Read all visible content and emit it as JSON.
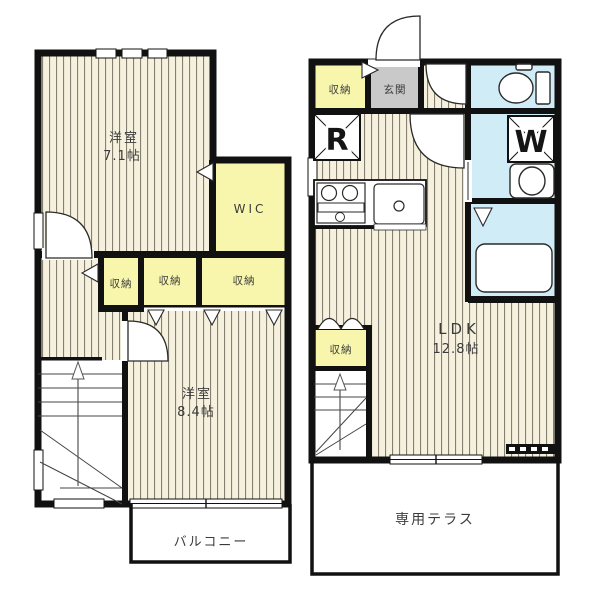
{
  "colors": {
    "wall": "#111111",
    "floor_base": "#f6f1de",
    "floor_stripe": "#847f6e",
    "closet_yellow": "#f8f6ad",
    "entrance_gray": "#c9c9c9",
    "wet_blue": "#cfecf7",
    "white": "#ffffff"
  },
  "floor2": {
    "room_a": {
      "name": "洋室",
      "size": "7.1帖"
    },
    "wic": "WIC",
    "storages": [
      "収納",
      "収納",
      "収納"
    ],
    "room_b": {
      "name": "洋室",
      "size": "8.4帖"
    },
    "balcony": "バルコニー"
  },
  "floor1": {
    "entry_storage": "収納",
    "entrance": "玄関",
    "refrigerator": "R",
    "washer": "W",
    "ldk": {
      "name": "LDK",
      "size": "12.8帖"
    },
    "ldk_storage": "収納",
    "terrace": "専用テラス"
  }
}
